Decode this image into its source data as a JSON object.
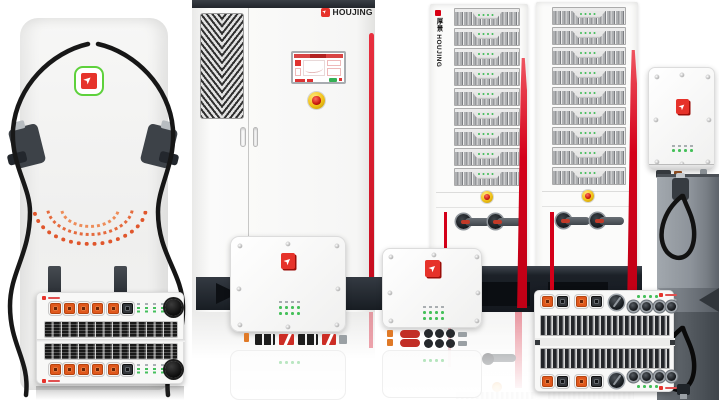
{
  "page": {
    "width": 719,
    "height": 400,
    "background": "#ffffff"
  },
  "brand": {
    "name": "HOUJING",
    "chinese_name": "厚景",
    "rack_side_label": "厚景 HOUJING",
    "logo_glyph": "➤",
    "logo_red": "#e6322a",
    "logo_green_ring": "#5ed13c"
  },
  "cabinet": {
    "logo_text": "HOUJING"
  },
  "racks": {
    "side_label": "厚景 HOUJING",
    "module_rows": 9,
    "leds_per_module": 4
  },
  "wallboxes": {
    "led_count": 4
  },
  "colors": {
    "accent_red": "#d40019",
    "connector_orange": "#e0571c",
    "led_green": "#45c05a",
    "estop_yellow": "#f0c117",
    "estop_red": "#cb1a10",
    "cabinet_top_dark": "#2a2f37",
    "base_dark": "#1d232b",
    "pole_gray": "#8d939a",
    "cable_black": "#151515",
    "body_white": "#f5f5f4"
  }
}
